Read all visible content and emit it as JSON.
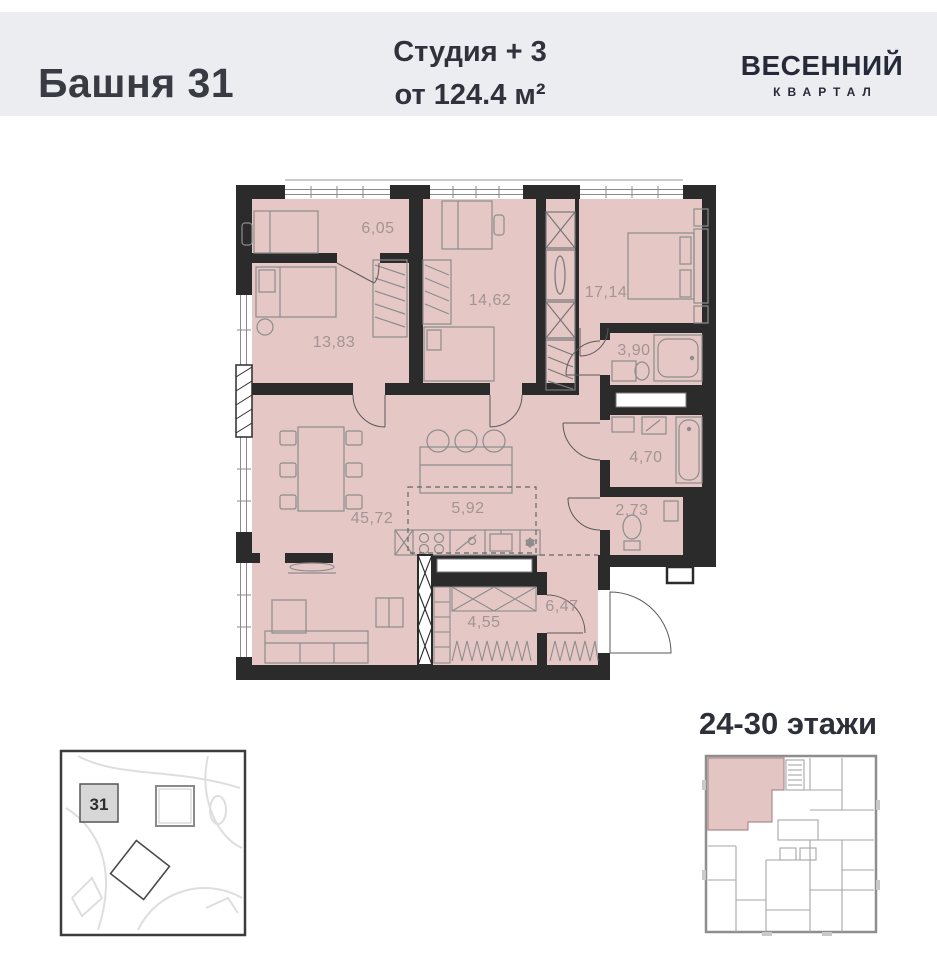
{
  "header": {
    "tower_name": "Башня 31",
    "unit_type": "Студия + 3",
    "unit_area": "от 124.4 м²",
    "brand_top": "ВЕСЕННИЙ",
    "brand_bottom": "КВАРТАЛ",
    "bg_color": "#ecedf1",
    "text_color": "#31343e"
  },
  "plan": {
    "fill_color": "#e5c7c5",
    "wall_color": "#2b2b2b",
    "label_color": "#a39494",
    "freeze_symbol": "❄",
    "rooms": [
      {
        "label": "6,05"
      },
      {
        "label": "13,83"
      },
      {
        "label": "14,62"
      },
      {
        "label": "17,14"
      },
      {
        "label": "3,90"
      },
      {
        "label": "4,70"
      },
      {
        "label": "2,73"
      },
      {
        "label": "45,72"
      },
      {
        "label": "5,92"
      },
      {
        "label": "4,55"
      },
      {
        "label": "6,47"
      }
    ]
  },
  "floors": {
    "label": "24-30 этажи"
  },
  "site_map": {
    "building_number": "31"
  }
}
